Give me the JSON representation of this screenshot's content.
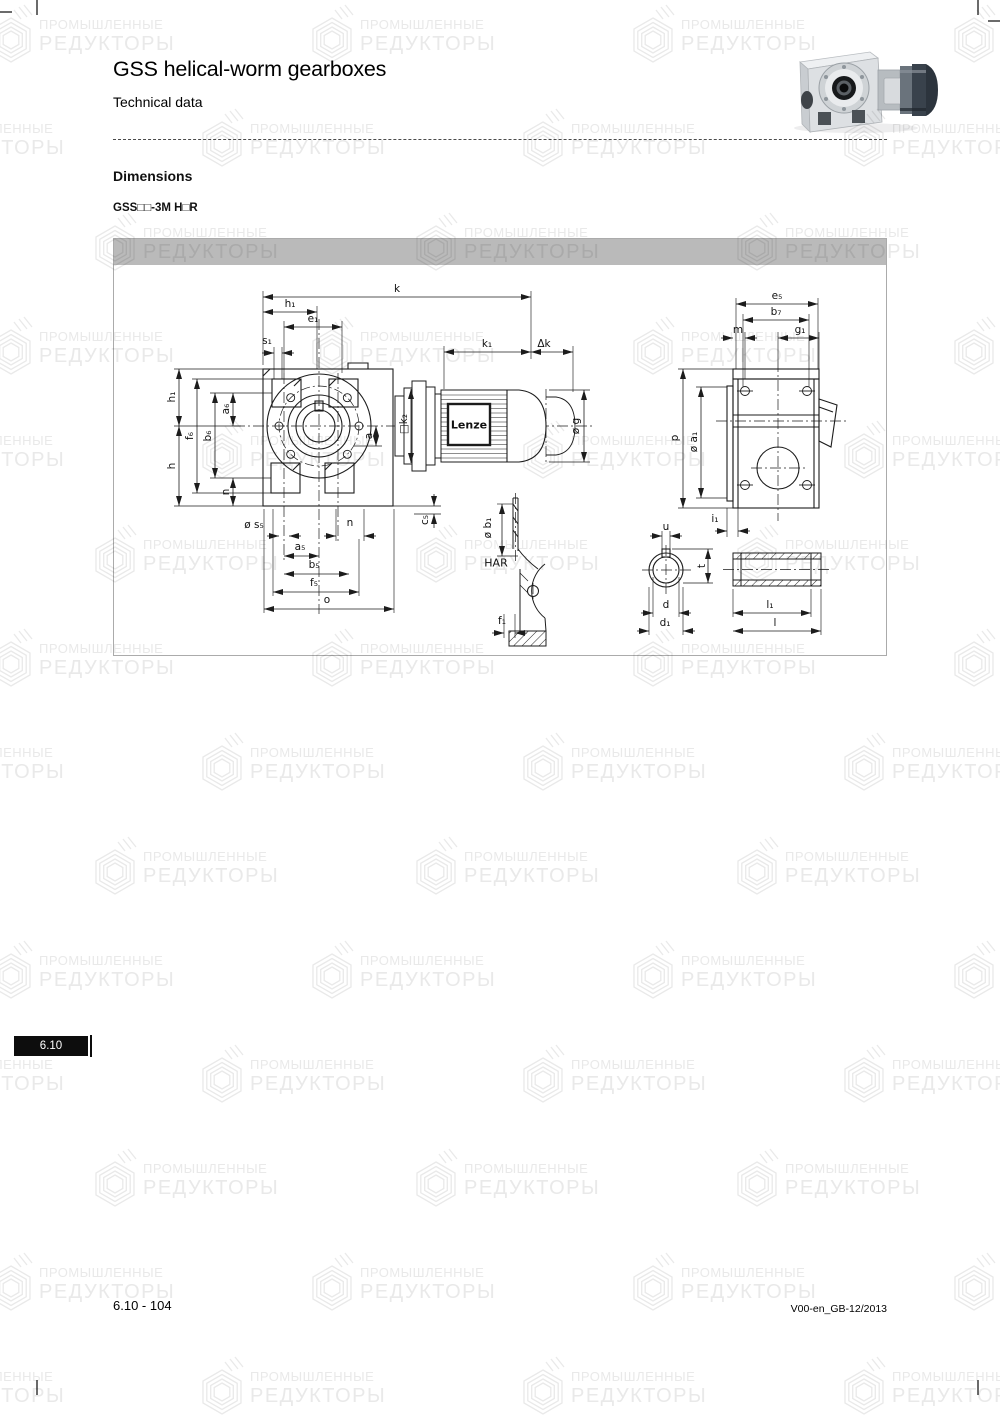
{
  "page": {
    "title": "GSS helical-worm gearboxes",
    "subtitle": "Technical data",
    "section_heading": "Dimensions",
    "model_code": "GSS□□-3M H□R",
    "tab_label": "6.10",
    "footer_left": "6.10 - 104",
    "footer_right": "V00-en_GB-12/2013"
  },
  "watermark": {
    "line1": "ПРОМЫШЛЕННЫЕ",
    "line2": "РЕДУКТОРЫ",
    "color": "#e9e9e9"
  },
  "colors": {
    "header_bar": "#bababa",
    "line": "#1c1c1c",
    "tab_bg": "#0d0d0d",
    "tab_fg": "#ffffff"
  },
  "drawing": {
    "motor_brand": "Lenze",
    "detail_view": "HAR",
    "labels": [
      {
        "t": "k",
        "x": 283,
        "y": 50
      },
      {
        "t": "h₁",
        "x": 176,
        "y": 65
      },
      {
        "t": "e₁",
        "x": 199,
        "y": 80
      },
      {
        "t": "s₁",
        "x": 153,
        "y": 102
      },
      {
        "t": "k₁",
        "x": 373,
        "y": 105
      },
      {
        "t": "Δk",
        "x": 430,
        "y": 105
      },
      {
        "t": "e₅",
        "x": 663,
        "y": 57
      },
      {
        "t": "b₇",
        "x": 662,
        "y": 73
      },
      {
        "t": "m",
        "x": 624,
        "y": 91
      },
      {
        "t": "g₁",
        "x": 686,
        "y": 91
      },
      {
        "t": "h₁",
        "x": 58,
        "y": 158,
        "r": 1
      },
      {
        "t": "f₆",
        "x": 76,
        "y": 197,
        "r": 1
      },
      {
        "t": "b₆",
        "x": 94,
        "y": 197,
        "r": 1
      },
      {
        "t": "a₆",
        "x": 112,
        "y": 170,
        "r": 1
      },
      {
        "t": "h",
        "x": 58,
        "y": 227,
        "r": 1
      },
      {
        "t": "n",
        "x": 112,
        "y": 253,
        "r": 1
      },
      {
        "t": "a",
        "x": 255,
        "y": 197,
        "r": 1
      },
      {
        "t": "□k₂",
        "x": 290,
        "y": 185,
        "r": 1
      },
      {
        "t": "ø g",
        "x": 462,
        "y": 187,
        "r": 1
      },
      {
        "t": "c₅",
        "x": 311,
        "y": 281,
        "r": 1
      },
      {
        "t": "ø s₅",
        "x": 140,
        "y": 286
      },
      {
        "t": "n",
        "x": 236,
        "y": 284
      },
      {
        "t": "a₅",
        "x": 186,
        "y": 308
      },
      {
        "t": "b₅",
        "x": 200,
        "y": 326
      },
      {
        "t": "f₅",
        "x": 200,
        "y": 344
      },
      {
        "t": "o",
        "x": 213,
        "y": 361
      },
      {
        "t": "p",
        "x": 561,
        "y": 199,
        "r": 1
      },
      {
        "t": "ø a₁",
        "x": 580,
        "y": 203,
        "r": 1
      },
      {
        "t": "i₁",
        "x": 601,
        "y": 280
      },
      {
        "t": "u",
        "x": 552,
        "y": 288
      },
      {
        "t": "t",
        "x": 588,
        "y": 327,
        "r": 1
      },
      {
        "t": "d",
        "x": 552,
        "y": 366
      },
      {
        "t": "d₁",
        "x": 551,
        "y": 384
      },
      {
        "t": "ø b₁",
        "x": 374,
        "y": 289,
        "r": 1
      },
      {
        "t": "HAR",
        "x": 382,
        "y": 324,
        "s": 11
      },
      {
        "t": "f₁",
        "x": 388,
        "y": 382
      },
      {
        "t": "l₁",
        "x": 656,
        "y": 366
      },
      {
        "t": "l",
        "x": 661,
        "y": 384
      },
      {
        "t": "Lenze",
        "x": 355,
        "y": 186,
        "b": 1,
        "s": 11
      }
    ]
  }
}
